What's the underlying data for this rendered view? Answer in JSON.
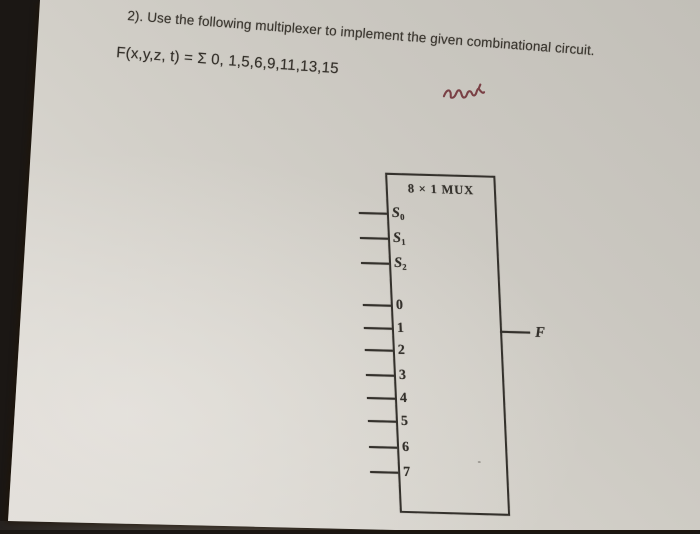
{
  "question": {
    "prompt": "2). Use the following multiplexer to implement the given combinational circuit.",
    "formula": "F(x,y,z, t) = Σ 0, 1,5,6,9,11,13,15"
  },
  "mux": {
    "title": "8 × 1 MUX",
    "select_inputs": [
      {
        "base": "S",
        "sub": "0"
      },
      {
        "base": "S",
        "sub": "1"
      },
      {
        "base": "S",
        "sub": "2"
      }
    ],
    "data_inputs": [
      "0",
      "1",
      "2",
      "3",
      "4",
      "5",
      "6",
      "7"
    ],
    "output_label": "F"
  },
  "colors": {
    "paper": "#d6d3cc",
    "ink": "#33302b",
    "question_text": "#3a362f",
    "desk_wood": "#c19c54",
    "desk_edge": "#5e4224",
    "desk_shadow": "#17120e",
    "scribble": "#6e2d34"
  }
}
